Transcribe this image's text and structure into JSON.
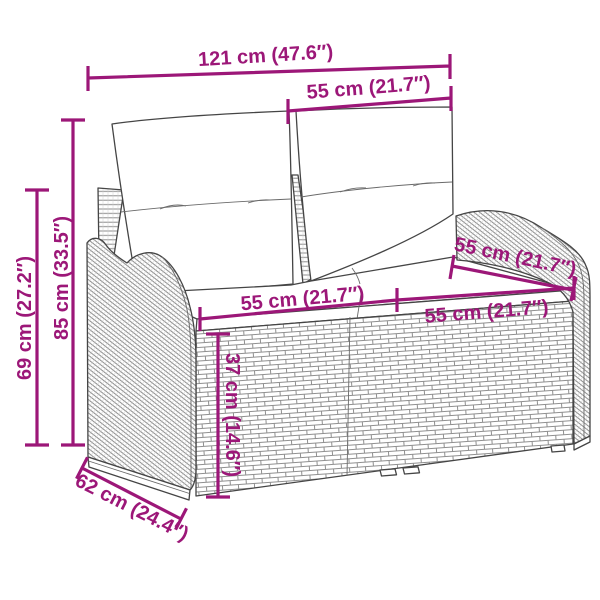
{
  "diagram": {
    "background": "#ffffff",
    "accent_color": "#9C1778",
    "outline_color": "#454545",
    "illustration": "two-seater poly rattan garden sofa with back and seat cushions (technical line drawing)",
    "dimensions": {
      "overall_width": "121 cm (47.6″)",
      "back_section_width": "55 cm (21.7″)",
      "overall_height": "85 cm (33.5″)",
      "arm_height": "69 cm (27.2″)",
      "seat_width_left": "55 cm (21.7″)",
      "seat_width_right": "55 cm (21.7″)",
      "seat_depth": "55 cm (21.7″)",
      "seat_height": "37 cm (14.6″)",
      "overall_depth": "62 cm (24.4″)"
    }
  }
}
